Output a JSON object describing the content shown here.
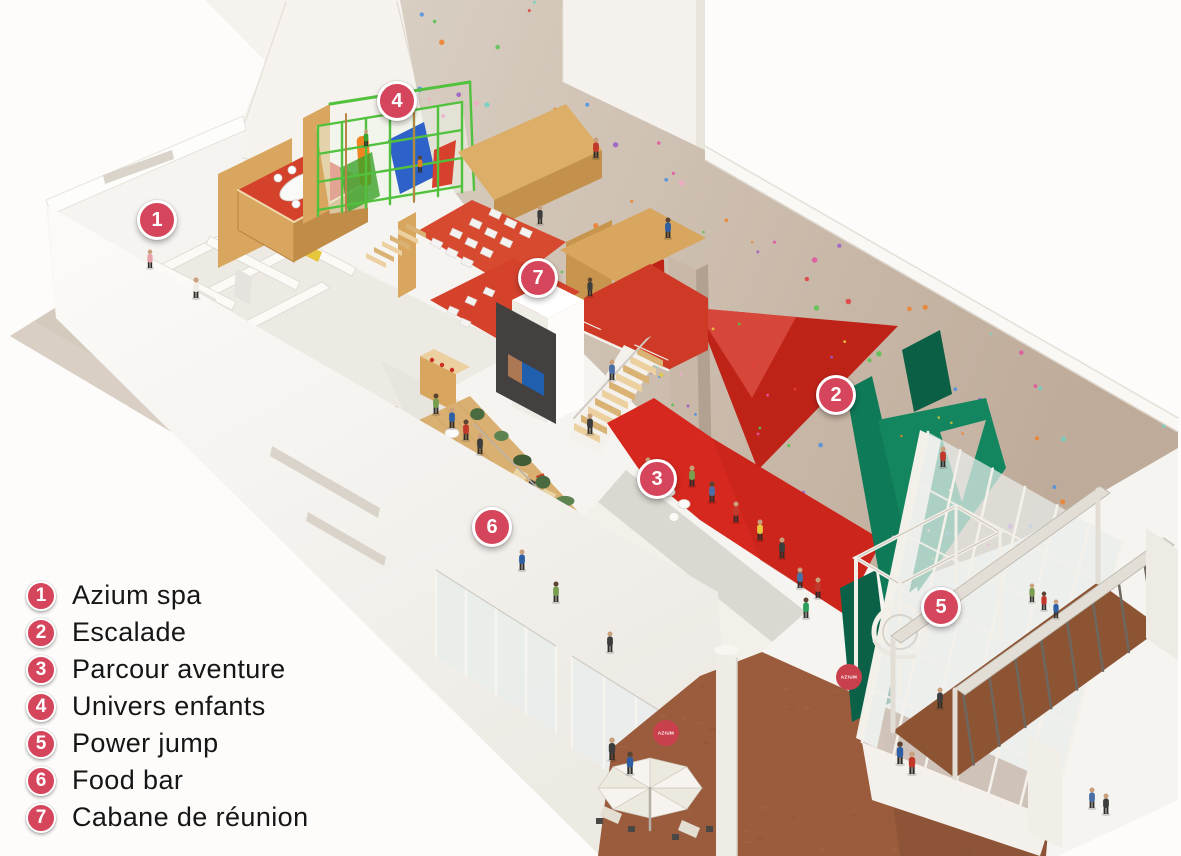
{
  "legend": {
    "items": [
      {
        "number": "1",
        "label": "Azium spa"
      },
      {
        "number": "2",
        "label": "Escalade"
      },
      {
        "number": "3",
        "label": "Parcour aventure"
      },
      {
        "number": "4",
        "label": "Univers enfants"
      },
      {
        "number": "5",
        "label": "Power jump"
      },
      {
        "number": "6",
        "label": "Food bar"
      },
      {
        "number": "7",
        "label": "Cabane de réunion"
      }
    ]
  },
  "markers": [
    {
      "number": "1",
      "label": "Azium spa",
      "x": 157,
      "y": 220
    },
    {
      "number": "2",
      "label": "Escalade",
      "x": 836,
      "y": 395
    },
    {
      "number": "3",
      "label": "Parcour aventure",
      "x": 657,
      "y": 479
    },
    {
      "number": "4",
      "label": "Univers enfants",
      "x": 397,
      "y": 101
    },
    {
      "number": "5",
      "label": "Power jump",
      "x": 941,
      "y": 607
    },
    {
      "number": "6",
      "label": "Food bar",
      "x": 492,
      "y": 527
    },
    {
      "number": "7",
      "label": "Cabane de réunion",
      "x": 538,
      "y": 278
    }
  ],
  "logos": [
    {
      "text": "AZIUM",
      "x": 666,
      "y": 733
    },
    {
      "text": "AZIUM",
      "x": 849,
      "y": 677
    }
  ],
  "colors": {
    "badge": "#d5455b",
    "logo_red": "#c9404d",
    "wall_beige_light": "#d8cec2",
    "wall_beige_dark": "#bfab99",
    "red_floor": "#d6281e",
    "red_carpet": "#d5422c",
    "red_triangle": "#bf2318",
    "orange_carpet": "#c74a2e",
    "plywood": "#d8a65e",
    "plywood_dark": "#c08c48",
    "kids_green": "#52c13d",
    "teal_wall": "#0f7a58",
    "wood_floor": "#d9b072",
    "terracotta": "#9a5c3c",
    "bridge_deck": "#8d5434",
    "sidewalk": "#d5cabe",
    "white_wall": "#f6f4f0",
    "holds": [
      "#e254a0",
      "#9b59c8",
      "#4b8fe2",
      "#e8c93e",
      "#57c24c",
      "#ef7f2a",
      "#e03c3c",
      "#6fd3c2",
      "#f3a8c8"
    ]
  }
}
